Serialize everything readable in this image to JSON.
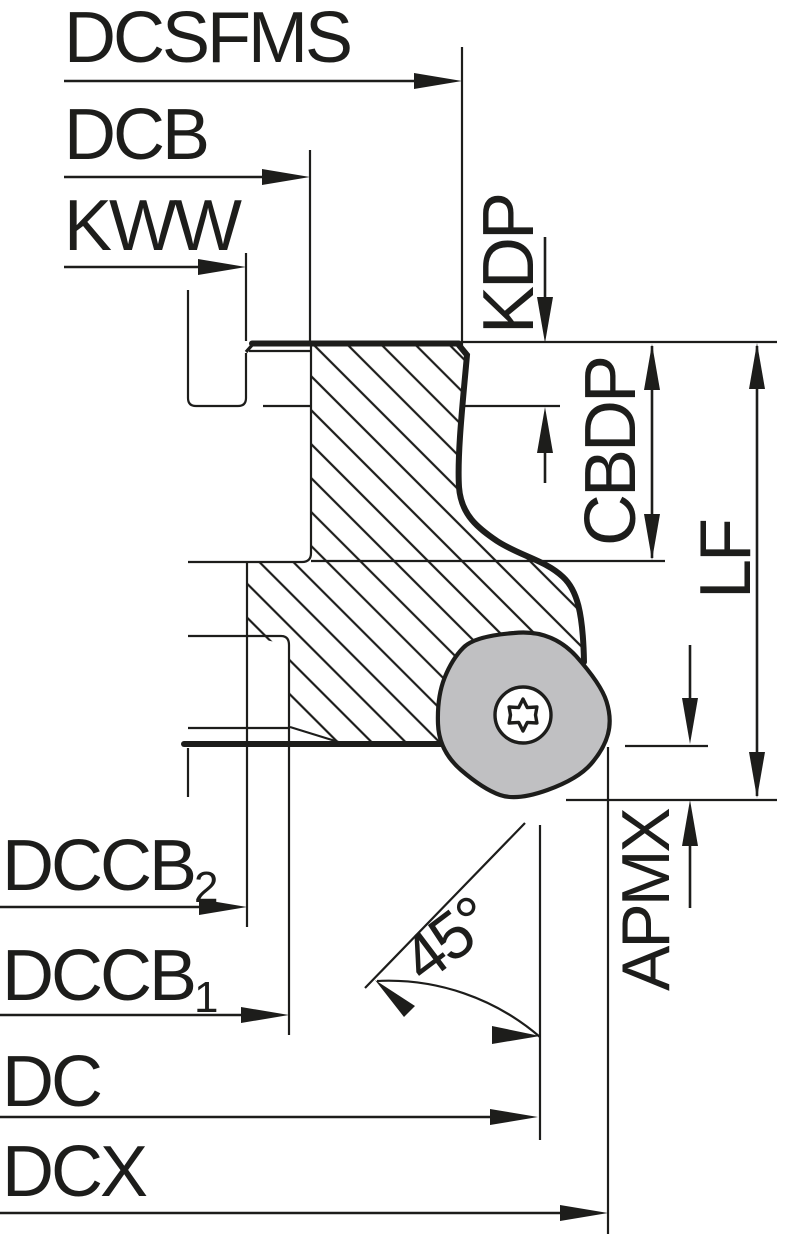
{
  "drawing": {
    "labels": {
      "dcsfms": "DCSFMS",
      "dcb": "DCB",
      "kww": "KWW",
      "kdp": "KDP",
      "cbdp": "CBDP",
      "lf": "LF",
      "apmx": "APMX",
      "dccb2_base": "DCCB",
      "dccb2_sub": "2",
      "dccb1_base": "DCCB",
      "dccb1_sub": "1",
      "dc": "DC",
      "dcx": "DCX",
      "angle": "45°"
    },
    "colors": {
      "line": "#1d1d1b",
      "insert_fill": "#c0c0c2",
      "screw_fill": "#ffffff",
      "background": "#ffffff"
    }
  }
}
